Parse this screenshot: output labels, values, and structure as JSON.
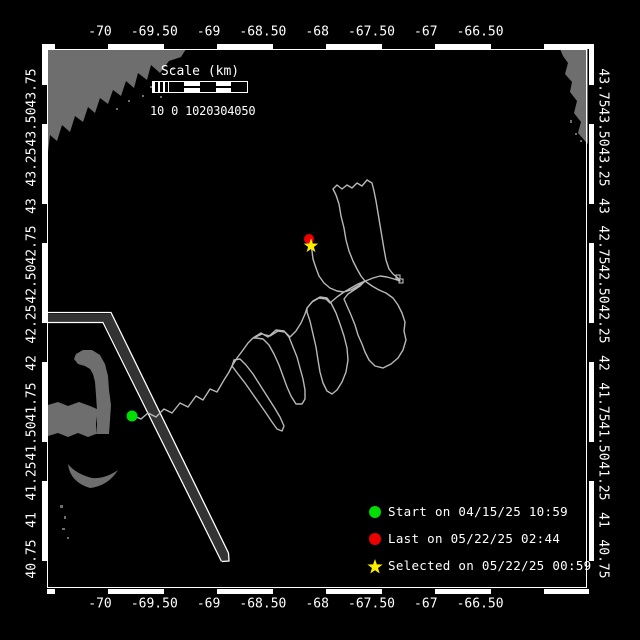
{
  "window": {
    "title": "Glider track map"
  },
  "axes": {
    "longitude_labels": [
      "-70",
      "-69.50",
      "-69",
      "-68.50",
      "-68",
      "-67.50",
      "-67",
      "-66.50"
    ],
    "latitude_labels": [
      "43.75",
      "43.50",
      "43.25",
      "43",
      "42.75",
      "42.50",
      "42.25",
      "42",
      "41.75",
      "41.50",
      "41.25",
      "41",
      "40.75"
    ]
  },
  "scale_bar": {
    "title": "Scale (km)",
    "tick_text": "10 0 1020304050"
  },
  "legend": {
    "items": [
      {
        "marker": "circle",
        "color": "#00dd00",
        "label": "Start on 04/15/25 10:59"
      },
      {
        "marker": "circle",
        "color": "#ee0000",
        "label": "Last on 05/22/25 02:44"
      },
      {
        "marker": "star",
        "color": "#ffee00",
        "label": "Selected on 05/22/25 00:59"
      }
    ]
  },
  "colors": {
    "background": "#000000",
    "land": "#6e6e6e",
    "track": "#b8b8b8",
    "shipping_lane_fill": "#333333",
    "frame": "#ffffff",
    "text": "#ffffff",
    "start_marker": "#00dd00",
    "last_marker": "#ee0000",
    "selected_marker": "#ffee00"
  }
}
